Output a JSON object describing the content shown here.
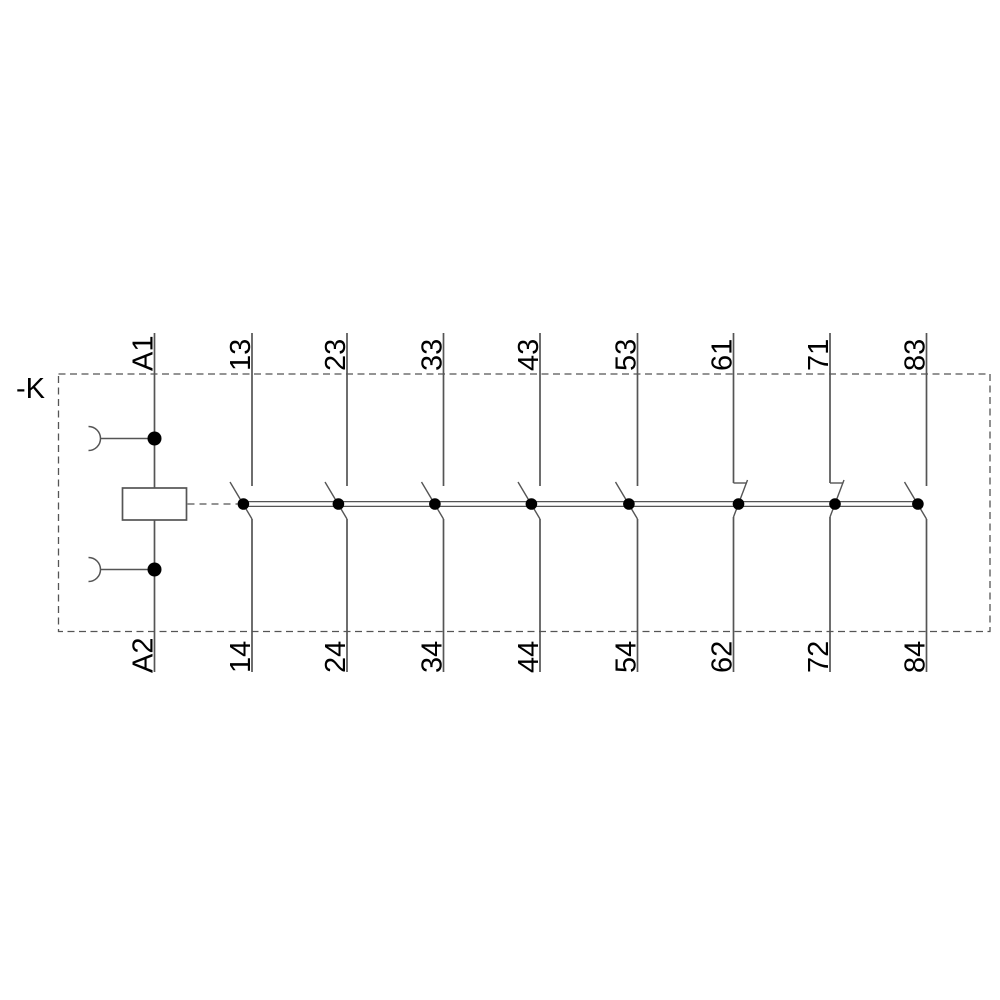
{
  "device_label": "-K",
  "coil": {
    "top_terminal": "A1",
    "bottom_terminal": "A2"
  },
  "contacts": [
    {
      "top": "13",
      "bottom": "14",
      "type": "NO"
    },
    {
      "top": "23",
      "bottom": "24",
      "type": "NO"
    },
    {
      "top": "33",
      "bottom": "34",
      "type": "NO"
    },
    {
      "top": "43",
      "bottom": "44",
      "type": "NO"
    },
    {
      "top": "53",
      "bottom": "54",
      "type": "NO"
    },
    {
      "top": "61",
      "bottom": "62",
      "type": "NC"
    },
    {
      "top": "71",
      "bottom": "72",
      "type": "NC"
    },
    {
      "top": "83",
      "bottom": "84",
      "type": "NO"
    }
  ],
  "colors": {
    "line": "#555555",
    "dot": "#000000",
    "text": "#000000",
    "background": "#ffffff"
  }
}
